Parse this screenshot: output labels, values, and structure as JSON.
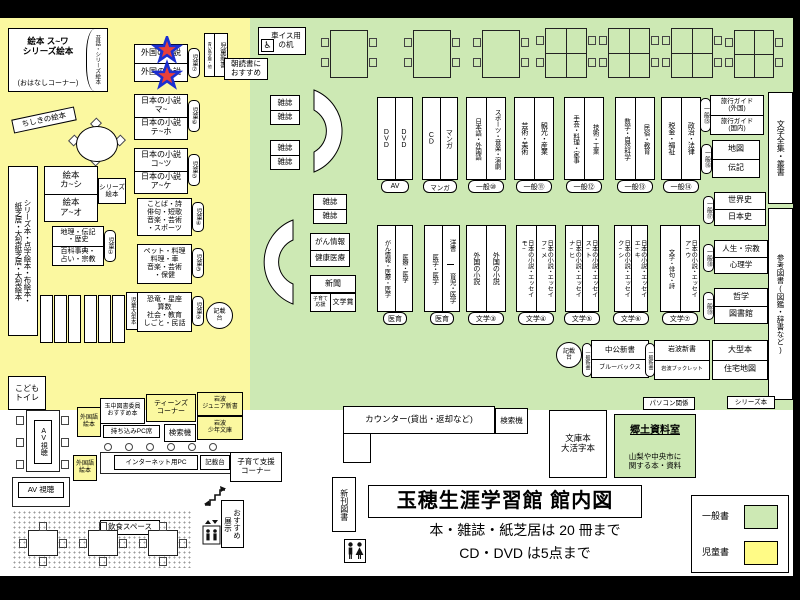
{
  "colors": {
    "children_area": "#FBF8A0",
    "general_area": "#CDE9B4",
    "search_kiosk": "#F29BC0",
    "star_fill": "#E8403A",
    "star_stroke": "#1B2FD0"
  },
  "title": {
    "main": "玉穂生涯学習館 館内図",
    "note1": "本・雑誌・紙芝居は 20 冊まで",
    "note2": "CD・DVD は5点まで"
  },
  "legend": {
    "general_label": "一般書",
    "children_label": "児童書"
  },
  "kids": {
    "ohanashi_main": "絵本 ス~ワ\nシリーズ絵本",
    "ohanashi_sub": "(おはなしコーナー)",
    "ohanashi_side": "昔話・シリーズ絵本",
    "chishiki": "ちしきの絵本",
    "left_strip": "シリーズ本・点字絵本・布絵本・\n紙芝居・大型紙芝居・大型絵本",
    "ehon_top": "絵本\nカ~シ",
    "ehon_bottom": "絵本\nア~オ",
    "series_ehon": "シリーズ\n絵本",
    "chiri_top": "地理・伝記\n・歴史",
    "chiri_bottom": "百科事典・\n占い・宗教",
    "chiri_badge": "児童①",
    "large_books": "児童大型本",
    "foreign_top": "外国の小説",
    "foreign_bottom": "外国の小説",
    "foreign_badge": "児童⑦",
    "jp1_top": "日本の小説\nマ~",
    "jp1_bottom": "日本の小説\nテ~ホ",
    "jp1_badge": "児童⑥",
    "jp2_top": "日本の小説\nコ~ツ",
    "jp2_bottom": "日本の小説\nア~ケ",
    "jp2_badge": "児童⑤",
    "kotoba": "ことば・詩\n俳句・短歌\n音楽・芸術\n・スポーツ",
    "kotoba_badge": "児童④",
    "pet": "ペット・料理\n料理・車\n音楽・芸術\n・保健",
    "pet_badge": "児童③",
    "dino": "恐竜・星座\n算数\n社会・教育\nしごと・民話",
    "dino_badge": "児童②",
    "kisaidai": "記載\n台",
    "aoitori": "青い鳥文庫・他",
    "jido_shinsho": "児童新書",
    "asadoku": "朝読書に\nおすすめ",
    "wheelchair_desk": "車イス用\nの机",
    "wheelchair_icon": "♿",
    "kodomo_toilet": "こども\nトイレ"
  },
  "general": {
    "magazine": "雑誌",
    "gan_top": "がん情報",
    "gan_bottom": "健康医療",
    "shinbun": "新聞",
    "kosodate_ouen": "子育て\n応援",
    "bungakusho": "文学賞",
    "row1": [
      {
        "left": "DVD",
        "right": "DVD",
        "badge": "AV"
      },
      {
        "left": "CD",
        "right": "マンガ",
        "badge": "マンガ"
      },
      {
        "left": "日本語・外国語",
        "right": "スポーツ・音楽・演劇",
        "badge": "一般⑩"
      },
      {
        "left": "芸術・美術",
        "right": "観光・産業",
        "badge": "一般⑪"
      },
      {
        "left": "手芸・料理・家事",
        "right": "技術・工業",
        "badge": "一般⑫"
      },
      {
        "left": "数学・自然科学",
        "right": "民俗・教育",
        "badge": "一般⑬"
      },
      {
        "left": "税金・福祉",
        "right": "政治・法律",
        "badge": "一般⑭"
      }
    ],
    "row2": [
      {
        "left": "がん情報・医療・医学",
        "right": "医療・医学",
        "badge": "医育"
      },
      {
        "left": "医学・医学",
        "right_top": "洋書",
        "right_bottom": "育児・医学",
        "badge": "医育"
      },
      {
        "left": "外国の小説",
        "right": "外国の小説",
        "badge": "文学③"
      },
      {
        "left": "日本の小説・エッセイ\nモ~",
        "right": "日本の小説・エッセイ\nフ~メ",
        "badge": "文学④"
      },
      {
        "left": "日本の小説・エッセイ\nナ~ヒ",
        "right": "日本の小説・エッセイ\nス~ト",
        "badge": "文学⑤"
      },
      {
        "left": "日本の小説・エッセイ\nク~シ",
        "right": "日本の小説・エッセイ\nエ~キ",
        "badge": "文学⑥"
      },
      {
        "left": "文学・俳句・詩",
        "right": "日本の小説・エッセイ\nア~ウ",
        "badge": "文学⑦"
      }
    ],
    "right_boxes": [
      {
        "top": "旅行ガイド\n(外国)",
        "bottom": "旅行ガイド\n(国内)",
        "badge": "一般⑮"
      },
      {
        "top": "地図",
        "bottom": "伝記",
        "badge": "一般⑯"
      },
      {
        "top": "世界史",
        "bottom": "日本史",
        "badge": "一般⑰"
      },
      {
        "top": "人生・宗教",
        "bottom": "心理学",
        "badge": "一般⑱"
      },
      {
        "top": "哲学",
        "bottom": "図書館",
        "badge": "一般⑲"
      },
      {
        "top": "大型本",
        "bottom": "住宅地図"
      },
      {
        "top": "岩波新書",
        "bottom": "岩波ブックレット",
        "badge": "一般新書"
      },
      {
        "top": "中公新書",
        "bottom": "ブルーバックス",
        "badge": "一般新書"
      }
    ],
    "zenshu": "文学全集・叢書",
    "sanko": "参考図書(図鑑・辞書など)",
    "kisaidai": "記載\n台",
    "pasokon": "パソコン関係",
    "series_bon": "シリーズ本"
  },
  "bottom": {
    "counter": "カウンター(貸出・返却など)",
    "kensakuki": "検索機",
    "bunko": "文庫本\n大活字本",
    "kyodo_title": "郷土資料室",
    "kyodo_sub": "山梨や中央市に\n関する本・資料",
    "shinkan": "新刊図書"
  },
  "southwest": {
    "av_vertical": "AV視聴",
    "av_label": "AV 視聴",
    "foreign_ehon": "外国語\n絵本",
    "tamachu": "玉中図書委員\nおすすめ本",
    "teens": "ティーンズ\nコーナー",
    "iwanami_junior": "岩波\nジュニア新書",
    "iwanami_shonen": "岩波\n少年文庫",
    "mochikomi": "持ち込みPC席",
    "kensakuki": "検索機",
    "internet": "インターネット用PC",
    "kisaidai": "記載台",
    "kosodate_shien": "子育て支援\nコーナー",
    "osusume": "おすすめ\n展示",
    "inshoku": "飲食スペース"
  }
}
